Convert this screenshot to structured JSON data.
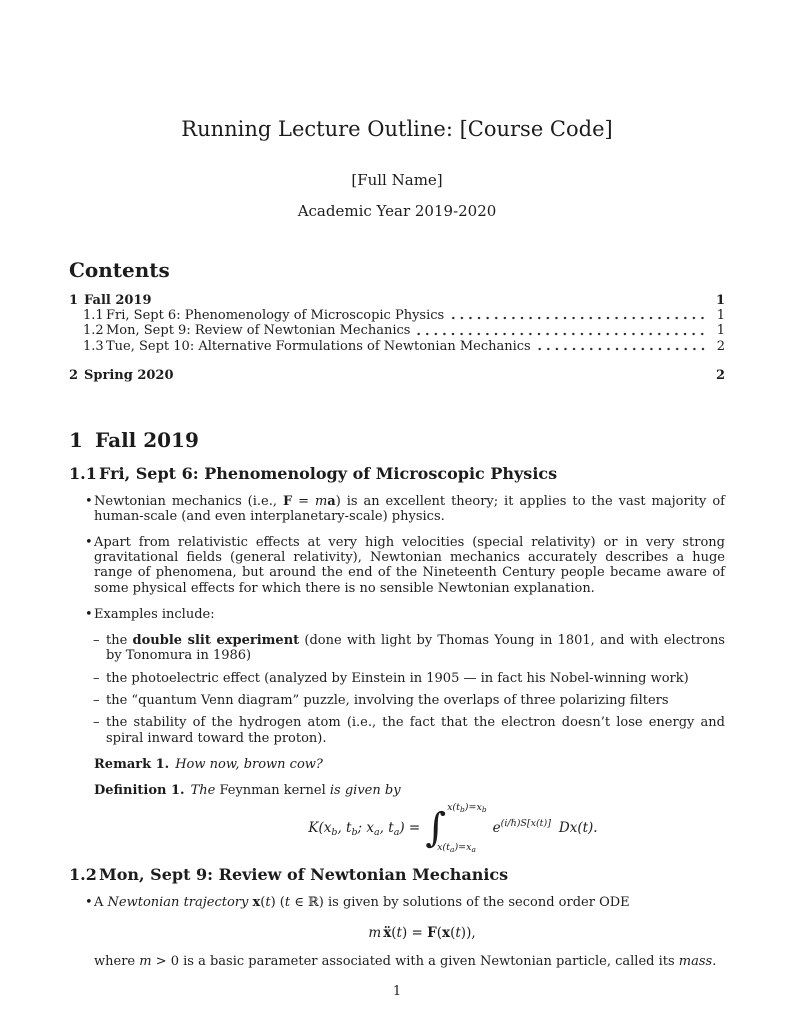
{
  "glyphs": {
    "bullet": "•",
    "dash": "–",
    "integral": "∫"
  },
  "page": {
    "number": "1"
  },
  "header": {
    "title": "Running Lecture Outline: [Course Code]",
    "author": "[Full Name]",
    "date": "Academic Year 2019-2020"
  },
  "toc": {
    "heading": "Contents",
    "entries": [
      {
        "num": "1",
        "label": "Fall 2019",
        "page": "1"
      },
      {
        "num": "1.1",
        "label": "Fri, Sept 6: Phenomenology of Microscopic Physics",
        "page": "1"
      },
      {
        "num": "1.2",
        "label": "Mon, Sept 9: Review of Newtonian Mechanics",
        "page": "1"
      },
      {
        "num": "1.3",
        "label": "Tue, Sept 10: Alternative Formulations of Newtonian Mechanics",
        "page": "2"
      },
      {
        "num": "2",
        "label": "Spring 2020",
        "page": "2"
      }
    ]
  },
  "section1": {
    "num": "1",
    "title": "Fall 2019"
  },
  "sub11": {
    "num": "1.1",
    "title": "Fri, Sept 6: Phenomenology of Microscopic Physics",
    "b1": {
      "t1": "Newtonian mechanics (i.e., ",
      "F": "F",
      "t2": " = ",
      "m": "m",
      "a": "a",
      "t3": ") is an excellent theory; it applies to the vast majority of human-scale (and even interplanetary-scale) physics."
    },
    "b2": "Apart from relativistic effects at very high velocities (special relativity) or in very strong gravitational fields (general relativity), Newtonian mechanics accurately describes a huge range of phenomena, but around the end of the Nineteenth Century people became aware of some physical effects for which there is no sensible Newtonian explanation.",
    "b3": "Examples include:",
    "sb1": {
      "t1": "the ",
      "b": "double slit experiment",
      "t2": " (done with light by Thomas Young in 1801, and with electrons by Tonomura in 1986)"
    },
    "sb2": "the photoelectric effect (analyzed by Einstein in 1905 — in fact his Nobel-winning work)",
    "sb3": "the “quantum Venn diagram” puzzle, involving the overlaps of three polarizing filters",
    "sb4": "the stability of the hydrogen atom (i.e., the fact that the electron doesn’t lose energy and spiral inward toward the proton).",
    "remark": {
      "label": "Remark 1.",
      "body": "How now, brown cow?"
    },
    "definition": {
      "label": "Definition 1.",
      "t1": "The ",
      "t2": "Feynman kernel",
      "t3": " is given by"
    },
    "eq": {
      "p1": "K(x",
      "s1": "b",
      "p2": ", t",
      "s2": "b",
      "p3": "; x",
      "s3": "a",
      "p4": ", t",
      "s4": "a",
      "p5": ") =",
      "sup": {
        "t1": "x(t",
        "s1": "b",
        "t2": ")=x",
        "s2": "b"
      },
      "sub": {
        "t1": "x(t",
        "s1": "a",
        "t2": ")=x",
        "s2": "a"
      },
      "e": "e",
      "exp": "(i/ℏ)S[x(t)]",
      "D": "D",
      "tail": "x(t)."
    }
  },
  "sub12": {
    "num": "1.2",
    "title": "Mon, Sept 9: Review of Newtonian Mechanics",
    "b1": {
      "t1": "A ",
      "i1": "Newtonian trajectory ",
      "x": "x",
      "p1": "(",
      "v1": "t",
      "p2": ") (",
      "v2": "t",
      "p3": " ∈ ℝ) is given by solutions of the second order ODE"
    },
    "eq": {
      "m": "m",
      "xdd": "ẍ",
      "p1": "(",
      "v1": "t",
      "p2": ") = ",
      "F": "F",
      "p3": "(",
      "x2": "x",
      "p4": "(",
      "v2": "t",
      "p5": ")),"
    },
    "after": {
      "t1": "where ",
      "m": "m",
      "t2": " > 0 is a basic parameter associated with a given Newtonian particle, called its ",
      "i1": "mass",
      "t3": "."
    }
  }
}
